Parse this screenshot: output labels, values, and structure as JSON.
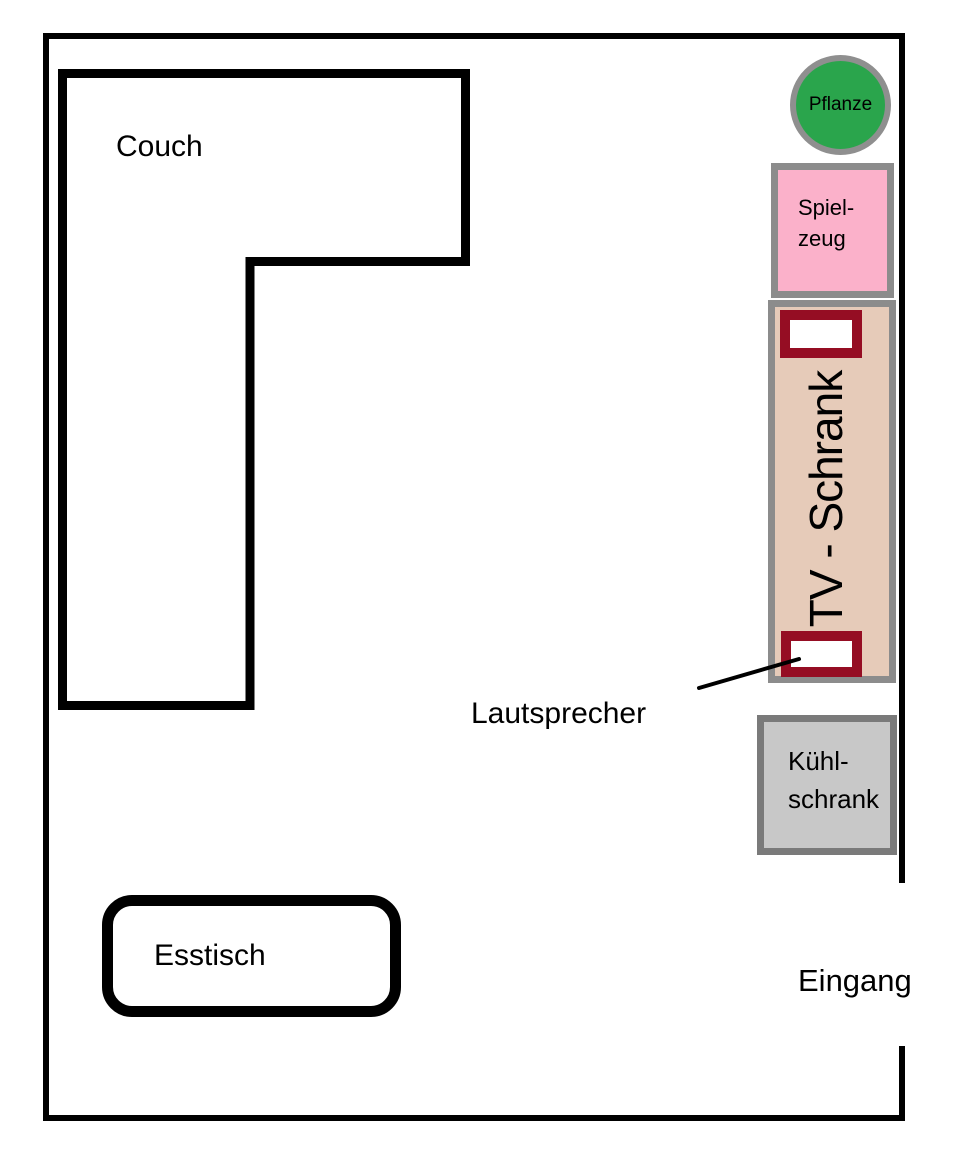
{
  "title": "Room floor plan sketch",
  "colors": {
    "background": "#FFFFFF",
    "wall": "#000000",
    "outline": "#000000",
    "text": "#000000",
    "pflanze_fill": "#2AA54C",
    "pflanze_border": "#8F8F8F",
    "spielzeug_fill": "#FBB1CA",
    "spielzeug_border": "#8C8C8C",
    "tv_schrank_fill": "#E6CBB9",
    "tv_schrank_border": "#8C8C8C",
    "speaker_fill": "#FFFFFF",
    "speaker_border": "#950D23",
    "kuehlschrank_fill": "#C8C8C8",
    "kuehlschrank_border": "#7A7A7A"
  },
  "labels": {
    "couch": "Couch",
    "esstisch": "Esstisch",
    "pflanze": "Pflanze",
    "spielzeug_line1": "Spiel-",
    "spielzeug_line2": "zeug",
    "tv_schrank": "TV - Schrank",
    "kuehlschrank_line1": "Kühl-",
    "kuehlschrank_line2": "schrank",
    "lautsprecher": "Lautsprecher",
    "eingang": "Eingang"
  }
}
